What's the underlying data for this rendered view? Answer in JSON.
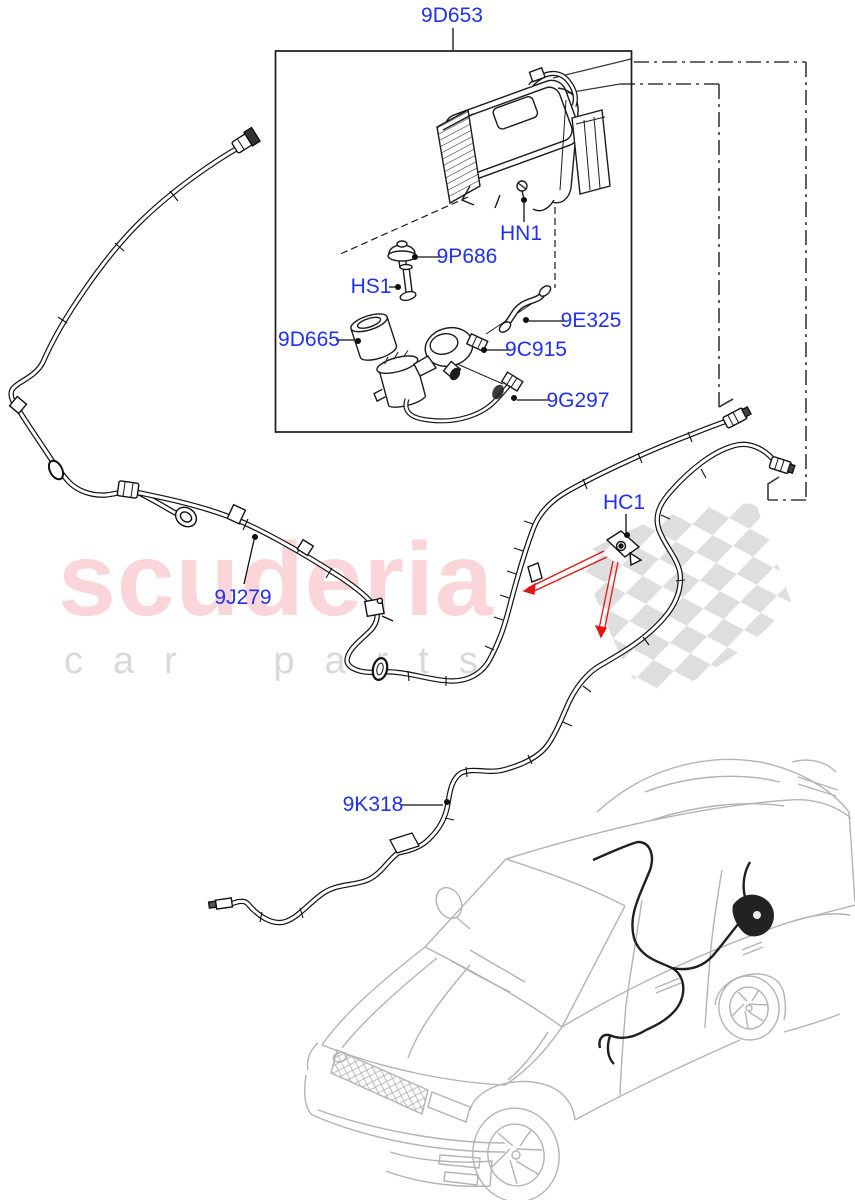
{
  "watermark": {
    "brand": "scuderia",
    "tagline": "car parts",
    "brand_color": "#fad6db",
    "tagline_color": "#d9d9d9"
  },
  "diagram": {
    "label_color": "#2230ee",
    "leader_color": "#111111",
    "highlight_color": "#e51515",
    "flag_color": "#dcdcdc",
    "labels": [
      {
        "id": "9D653",
        "text": "9D653"
      },
      {
        "id": "HN1",
        "text": "HN1"
      },
      {
        "id": "9P686",
        "text": "9P686"
      },
      {
        "id": "HS1",
        "text": "HS1"
      },
      {
        "id": "9D665",
        "text": "9D665"
      },
      {
        "id": "9E325",
        "text": "9E325"
      },
      {
        "id": "9C915",
        "text": "9C915"
      },
      {
        "id": "9G297",
        "text": "9G297"
      },
      {
        "id": "HC1",
        "text": "HC1"
      },
      {
        "id": "9J279",
        "text": "9J279"
      },
      {
        "id": "9K318",
        "text": "9K318"
      }
    ]
  }
}
